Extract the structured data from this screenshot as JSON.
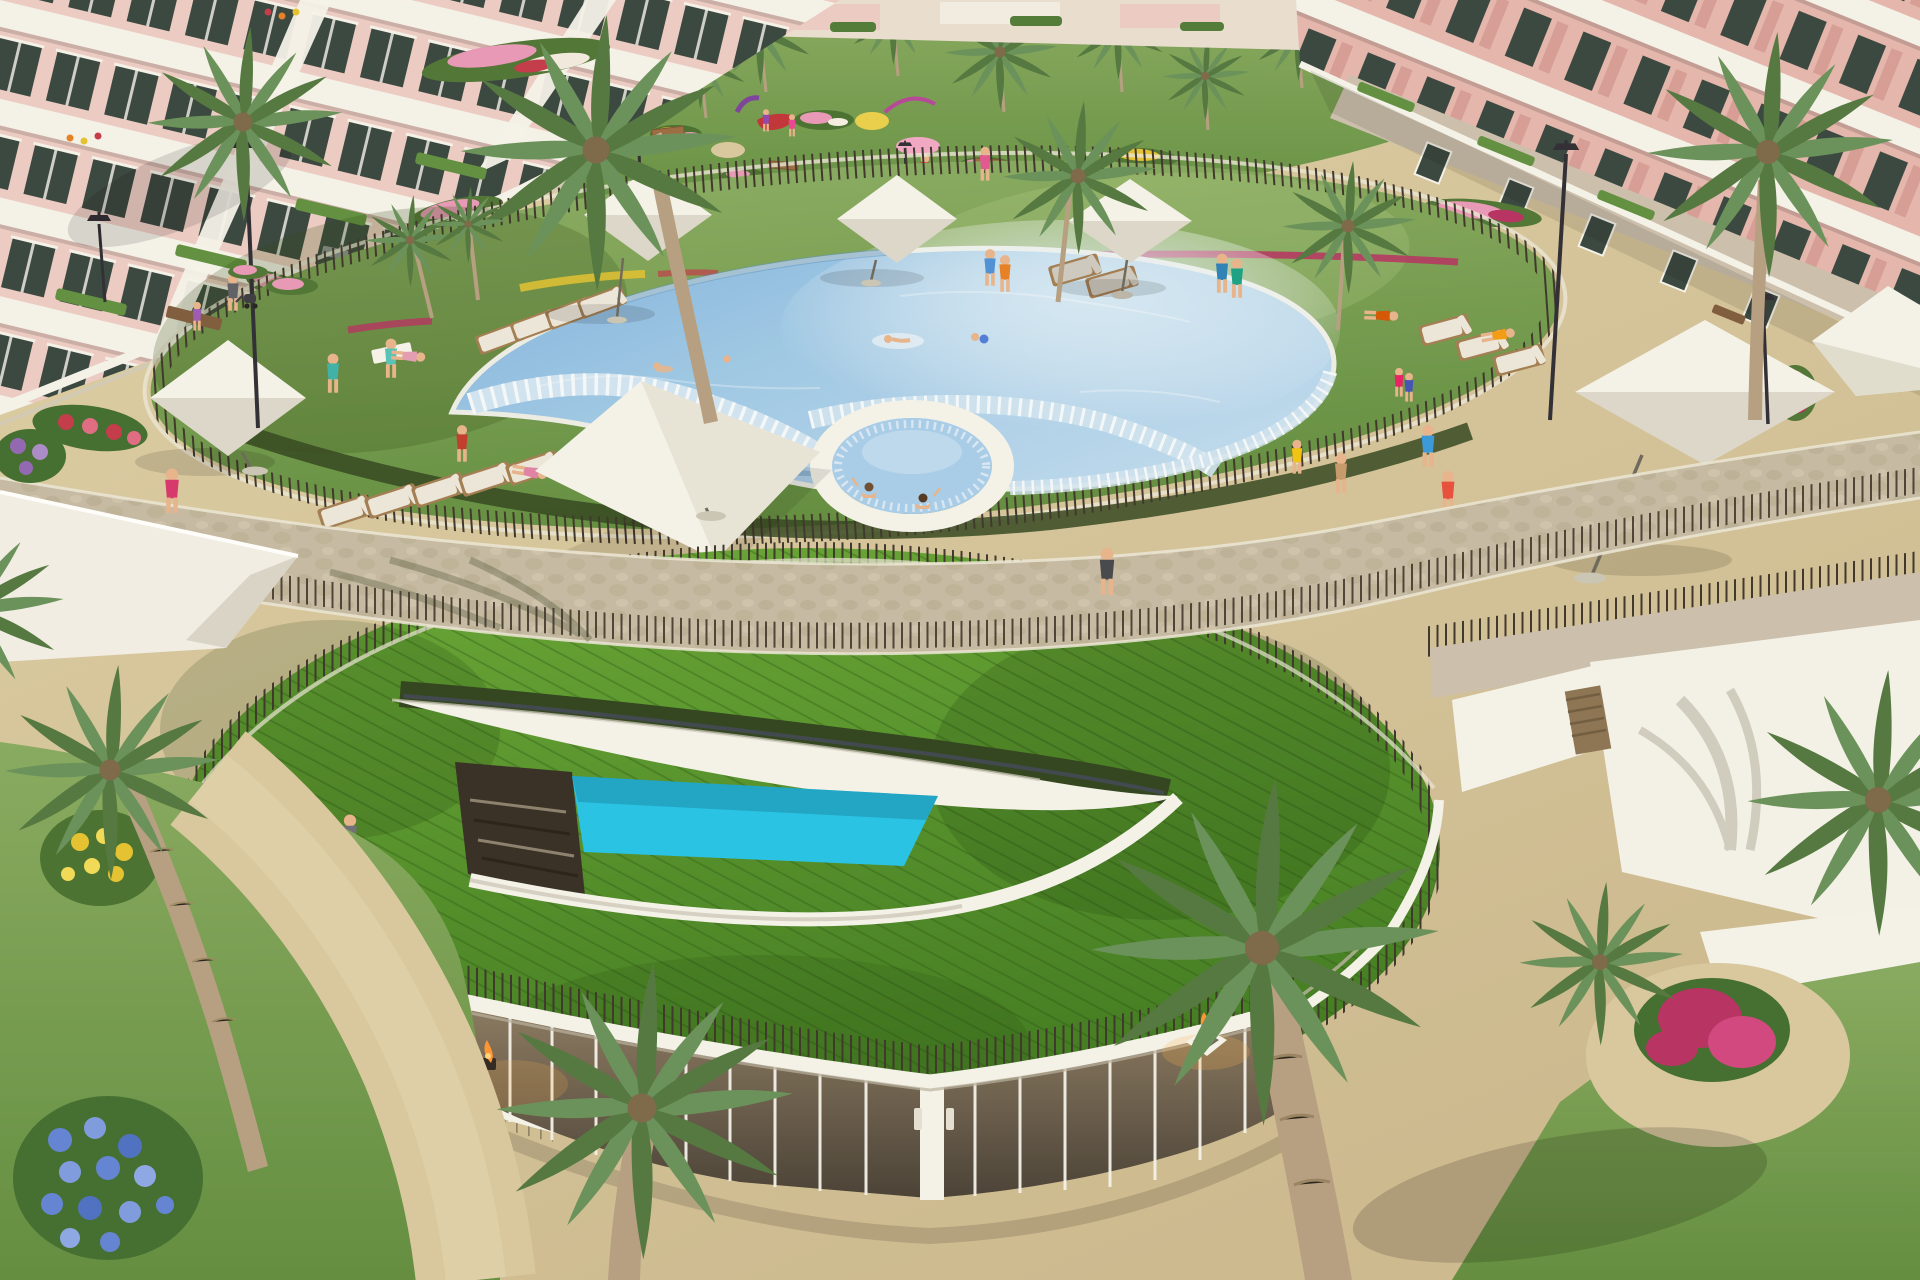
{
  "meta": {
    "title": "Aerial 3D rendering of a resort apartment complex",
    "alt": "Aerial architectural rendering: pink apartment blocks with white balconies surround a landscaped garden, an elliptical lawn with a free-form lagoon pool and circular spa, white parasols and sun loungers, a round grass-roofed clubhouse with a lens-shaped skylight over a turquoise plunge pool, sandy paths, flower beds and palm trees."
  },
  "palette": {
    "sand": "#d8c8a0",
    "sand2": "#cbb98e",
    "sandshadow": "#b3a47c",
    "stone": "#c4bba4",
    "stone2": "#b2a88d",
    "curb": "#ebe7d8",
    "lawn": "#7ea45c",
    "lawn2": "#5f8c3c",
    "lawndark": "#3f6b2a",
    "roofgrass": "#5ea832",
    "roofgrass2": "#3c7a1e",
    "hedge": "#2c421d",
    "water": "#9cc8e8",
    "waterdeep": "#5e9dd0",
    "waterpale": "#cfe4f3",
    "spa": "#a6cdec",
    "plunge": "#23c3e8",
    "white": "#f4f3ec",
    "whiteshade": "#dbd8cb",
    "fence": "#3a332a",
    "pink": "#e3b6ae",
    "pink2": "#d59d96",
    "pinklight": "#eccdc5",
    "stonewall": "#cabfae",
    "glass": "#35443f",
    "glasswood": "#7a6a55",
    "palm": "#67905a",
    "palm2": "#50763f",
    "trunk": "#b49f82",
    "wood": "#a07c52",
    "pad": "#ece8dc",
    "padgrey": "#cbc9c1",
    "magenta": "#b52e62",
    "pinkfl": "#e897b8",
    "yellowfl": "#e3c22f",
    "bluefl": "#5f83d6",
    "purplefl": "#8f65b5",
    "redfl": "#c23848",
    "fire": "#ff9430",
    "skin": "#e6b48c",
    "dark": "#2b2b33"
  },
  "scene": {
    "buildings": {
      "left": "pink apartment block with white balcony bands",
      "right": "pink apartment block with stone-clad base",
      "back": "low white garden walls and distant facades"
    },
    "garden": {
      "label": "central garden with playground",
      "palm_count": 9,
      "benches": 4,
      "play_equipment": [
        "red platform",
        "purple tube",
        "magenta swing arc"
      ],
      "ground_circles": [
        "yellow",
        "pink",
        "white"
      ]
    },
    "pool_area": {
      "lawn": "elliptical pool lawn ringed by picket fence",
      "pool": "free-form lagoon pool with beach-entry step bands",
      "spa": "circular spa attached to pool edge",
      "swimmers": 3,
      "spa_bathers": 2,
      "umbrellas": 7,
      "sun_loungers": 16,
      "towels": 2
    },
    "clubhouse": {
      "roof": "round grass roof with mow stripes",
      "skylight": "lens-shaped roof opening",
      "plunge_pool": "turquoise plunge pool",
      "deck": "timber deck with steps",
      "facade": "curved glazed facade with white mullions",
      "fire_bowls": 2,
      "roof_visitor": 1
    },
    "paths": {
      "upper": "sand promenade along buildings",
      "middle": "stone paver walkway",
      "lower": "sand terrace"
    },
    "right_court": {
      "walls": "white service walls",
      "door": "timber slat gate",
      "bougainvillea": "magenta bougainvillea on sand circle"
    },
    "flowers": [
      "magenta",
      "pink",
      "yellow",
      "red",
      "blue hydrangea",
      "purple"
    ],
    "people_total": 31,
    "street_lamps": 6,
    "palms_total": 20
  }
}
